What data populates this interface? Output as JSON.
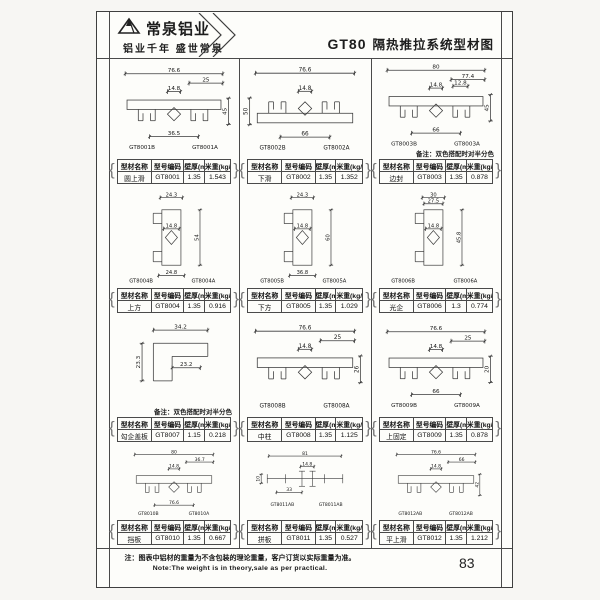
{
  "header": {
    "brand": "常泉铝业",
    "tagline": "铝业千年  盛世常泉",
    "model": "GT80",
    "title": "隔热推拉系统型材图"
  },
  "table_header": {
    "name": "型材名称",
    "code": "型号编码",
    "thickness": "壁厚(mm)",
    "weight": "米重(kg/m)"
  },
  "remark_text": "备注：双色搭配时对半分色",
  "footer": {
    "note_cn": "注：图表中铝材的重量为不含包装的理论重量，客户订货以实际重量为准。",
    "note_en": "Note:The weight is in theory,sale as per practical.",
    "page_number": "83"
  },
  "colors": {
    "ink": "#3a3a3a",
    "paper": "#fdfdfa"
  },
  "cells": [
    {
      "name": "圆上滑",
      "code": "GT8001",
      "thickness": "1.35",
      "weight": "1.543",
      "labels": [
        "GT8001B",
        "GT8001A"
      ],
      "remark": false,
      "drawing": {
        "type": "h",
        "dims": {
          "top": "76.6",
          "sub": "25",
          "inner": "14.8",
          "bottom": "36.5",
          "side": "45"
        }
      }
    },
    {
      "name": "下滑",
      "code": "GT8002",
      "thickness": "1.35",
      "weight": "1.352",
      "labels": [
        "GT8002B",
        "GT8002A"
      ],
      "remark": false,
      "drawing": {
        "type": "h",
        "flip": true,
        "dims": {
          "top": "76.6",
          "inner": "14.8",
          "bottom": "66",
          "side": "50",
          "side_pos": "left"
        }
      }
    },
    {
      "name": "边封",
      "code": "GT8003",
      "thickness": "1.35",
      "weight": "0.878",
      "labels": [
        "GT8003B",
        "GT8003A"
      ],
      "remark": true,
      "drawing": {
        "type": "h",
        "dims": {
          "top": "80",
          "sub": "77.4",
          "inner": "14.8",
          "inner2": "12.8",
          "bottom": "66",
          "side": "45"
        }
      }
    },
    {
      "name": "上方",
      "code": "GT8004",
      "thickness": "1.35",
      "weight": "0.916",
      "labels": [
        "GT8004B",
        "GT8004A"
      ],
      "remark": false,
      "drawing": {
        "type": "v",
        "dims": {
          "top": "24.3",
          "inner": "14.8",
          "bottom": "24.8",
          "side": "54"
        }
      }
    },
    {
      "name": "下方",
      "code": "GT8005",
      "thickness": "1.35",
      "weight": "1.029",
      "labels": [
        "GT8005B",
        "GT8005A"
      ],
      "remark": false,
      "drawing": {
        "type": "v",
        "dims": {
          "top": "24.3",
          "inner": "14.8",
          "bottom": "36.8",
          "side": "60"
        }
      }
    },
    {
      "name": "光企",
      "code": "GT8006",
      "thickness": "1.3",
      "weight": "0.774",
      "labels": [
        "GT8006B",
        "GT8006A"
      ],
      "remark": false,
      "drawing": {
        "type": "v",
        "dims": {
          "top": "30",
          "sub": "27.5",
          "inner": "14.8",
          "side": "45.8"
        }
      }
    },
    {
      "name": "勾企盖板",
      "code": "GT8007",
      "thickness": "1.15",
      "weight": "0.218",
      "labels": [],
      "remark": true,
      "drawing": {
        "type": "l",
        "dims": {
          "top": "34.2",
          "inner": "23.2",
          "side": "23.3"
        }
      }
    },
    {
      "name": "中柱",
      "code": "GT8008",
      "thickness": "1.35",
      "weight": "1.125",
      "labels": [
        "GT8008B",
        "GT8008A"
      ],
      "remark": false,
      "drawing": {
        "type": "h",
        "dims": {
          "top": "76.6",
          "sub": "25",
          "inner": "14.8",
          "side": "26"
        }
      }
    },
    {
      "name": "上固定",
      "code": "GT8009",
      "thickness": "1.35",
      "weight": "0.878",
      "labels": [
        "GT8009B",
        "GT8009A"
      ],
      "remark": false,
      "drawing": {
        "type": "h",
        "dims": {
          "top": "76.6",
          "sub": "25",
          "inner": "14.8",
          "bottom": "66",
          "side": "20"
        }
      }
    },
    {
      "name": "挡板",
      "code": "GT8010",
      "thickness": "1.35",
      "weight": "0.667",
      "labels": [
        "GT8010B",
        "GT8010A"
      ],
      "remark": false,
      "drawing": {
        "type": "h",
        "dims": {
          "top": "80",
          "sub": "36.7",
          "inner": "14.8",
          "bottom": "76.6"
        }
      }
    },
    {
      "name": "拼板",
      "code": "GT8011",
      "thickness": "1.35",
      "weight": "0.527",
      "labels": [
        "GT8011AB",
        "GT8011AB"
      ],
      "remark": false,
      "drawing": {
        "type": "c",
        "dims": {
          "top": "81",
          "inner": "14.8",
          "sub": "33",
          "side": "10",
          "side_pos": "left"
        }
      }
    },
    {
      "name": "平上滑",
      "code": "GT8012",
      "thickness": "1.35",
      "weight": "1.212",
      "labels": [
        "GT8012AB",
        "GT8012AB"
      ],
      "remark": false,
      "drawing": {
        "type": "h",
        "dims": {
          "top": "76.6",
          "sub": "66",
          "inner": "14.8",
          "side": "42"
        }
      }
    }
  ]
}
